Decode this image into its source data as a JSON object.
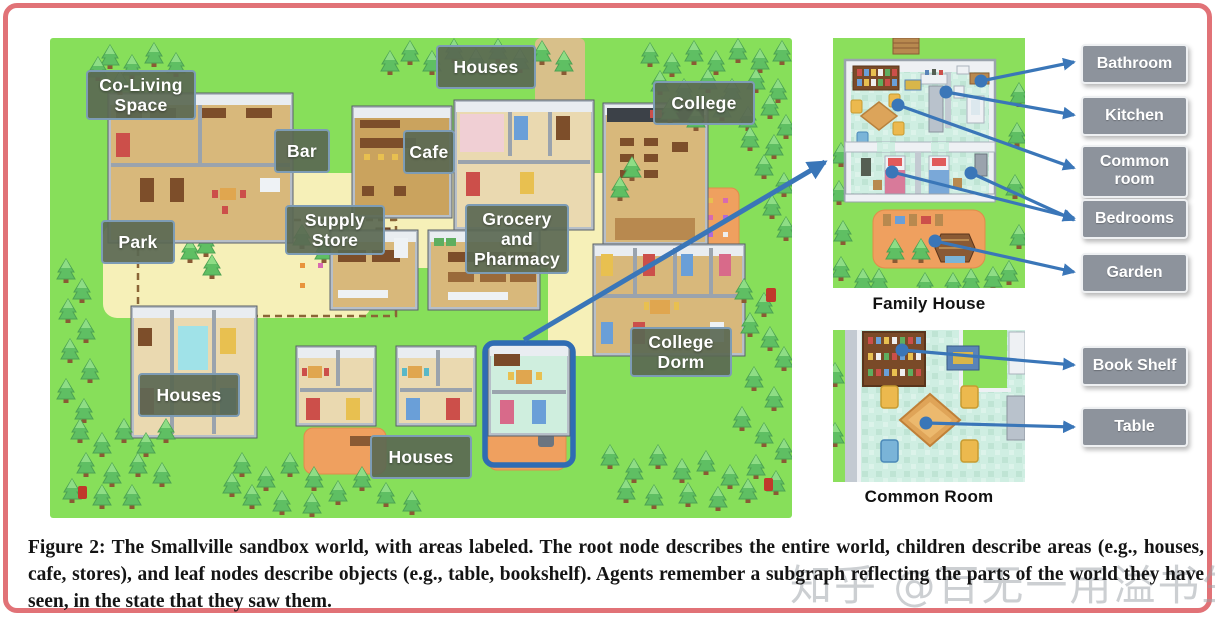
{
  "figure": {
    "caption": "Figure 2: The Smallville sandbox world, with areas labeled. The root node describes the entire world, children describe areas (e.g., houses, cafe, stores), and leaf nodes describe objects (e.g., table, bookshelf). Agents remember a subgraph reflecting the parts of the world they have seen, in the state that they saw them."
  },
  "watermark": "知乎 @百无一用溢书生",
  "map": {
    "labels": [
      {
        "text": "Co-Living Space"
      },
      {
        "text": "Houses"
      },
      {
        "text": "Bar"
      },
      {
        "text": "Cafe"
      },
      {
        "text": "College"
      },
      {
        "text": "Supply Store"
      },
      {
        "text": "Grocery and Pharmacy"
      },
      {
        "text": "Park"
      },
      {
        "text": "College Dorm"
      },
      {
        "text": "Houses"
      },
      {
        "text": "Houses"
      }
    ]
  },
  "panels": {
    "family_house": {
      "caption": "Family House",
      "labels": [
        "Bathroom",
        "Kitchen",
        "Common room",
        "Bedrooms",
        "Garden"
      ]
    },
    "common_room": {
      "caption": "Common Room",
      "labels": [
        "Book Shelf",
        "Table"
      ]
    }
  },
  "colors": {
    "arrow_blue": "#3a76b8",
    "highlight_blue": "#2f6cb3",
    "map_label_border": "#7d9cb5",
    "panel_label_bg": "#8d939c",
    "frame_pink": "#e17277",
    "grass_green": "#87df5a"
  }
}
